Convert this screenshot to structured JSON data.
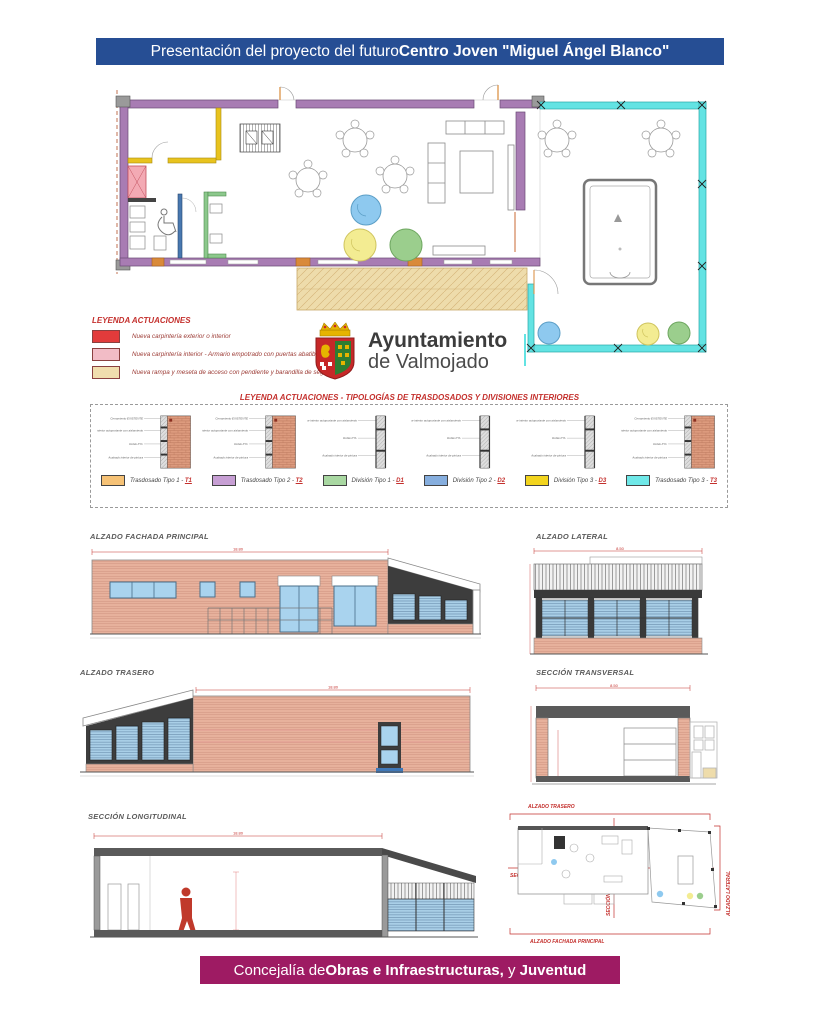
{
  "header": {
    "title_regular": "Presentación del proyecto del futuro ",
    "title_bold": "Centro Joven \"Miguel Ángel Blanco\"",
    "bg_color": "#264e94"
  },
  "logo": {
    "name_line1": "Ayuntamiento",
    "name_line2": "de Valmojado"
  },
  "legend_actuaciones": {
    "title": "LEYENDA ACTUACIONES",
    "items": [
      {
        "color": "#e23b3b",
        "label": "Nueva carpintería exterior o interior"
      },
      {
        "color": "#f2bcc6",
        "label": "Nueva carpintería interior - Armario empotrado con puertas abatibles"
      },
      {
        "color": "#f0ddae",
        "label": "Nueva rampa y meseta de acceso con pendiente y barandilla de seguridad"
      }
    ]
  },
  "legend_tipologias": {
    "title": "LEYENDA ACTUACIONES - TIPOLOGÍAS DE TRASDOSADOS Y DIVISIONES INTERIORES",
    "detail_labels_wall": [
      "Cerramiento EXISTENTE",
      "Trasdosado interior autoportante con aislamiento",
      "Doble PYL",
      "Acabado interior de pintura"
    ],
    "detail_labels_partition": [
      "Tabique interior autoportante con aislamiento",
      "Doble PYL",
      "Acabado interior de pintura"
    ],
    "types": [
      {
        "color": "#f6c276",
        "name": "Trasdosado Tipo 1 - ",
        "code": "T1"
      },
      {
        "color": "#c79fd4",
        "name": "Trasdosado Tipo 2 - ",
        "code": "T2"
      },
      {
        "color": "#a9d8a2",
        "name": "División Tipo 1 - ",
        "code": "D1"
      },
      {
        "color": "#86aede",
        "name": "División Tipo 2 - ",
        "code": "D2"
      },
      {
        "color": "#f2d41e",
        "name": "División Tipo 3 - ",
        "code": "D3"
      },
      {
        "color": "#6fe8e8",
        "name": "Trasdosado Tipo 3 - ",
        "code": "T3"
      }
    ]
  },
  "drawings": {
    "fachada_principal": {
      "title": "ALZADO FACHADA PRINCIPAL",
      "dim": "18.80"
    },
    "lateral": {
      "title": "ALZADO LATERAL",
      "dim": "8.50"
    },
    "trasero": {
      "title": "ALZADO TRASERO",
      "dim": "18.80"
    },
    "transversal": {
      "title": "SECCIÓN TRANSVERSAL",
      "dim": "8.50"
    },
    "longitudinal": {
      "title": "SECCIÓN LONGITUDINAL",
      "dim": "18.80"
    }
  },
  "key_plan": {
    "label_top": "ALZADO TRASERO",
    "label_left": "SECCIÓN LONGITUDINAL",
    "label_center": "SECCIÓN TRANSVERSAL",
    "label_right": "ALZADO LATERAL",
    "label_bottom": "ALZADO FACHADA PRINCIPAL"
  },
  "footer": {
    "part1": "Concejalía de ",
    "part2": "Obras e Infraestructuras,",
    "part3": " y ",
    "part4": "Juventud",
    "bg_color": "#9e1b63"
  }
}
